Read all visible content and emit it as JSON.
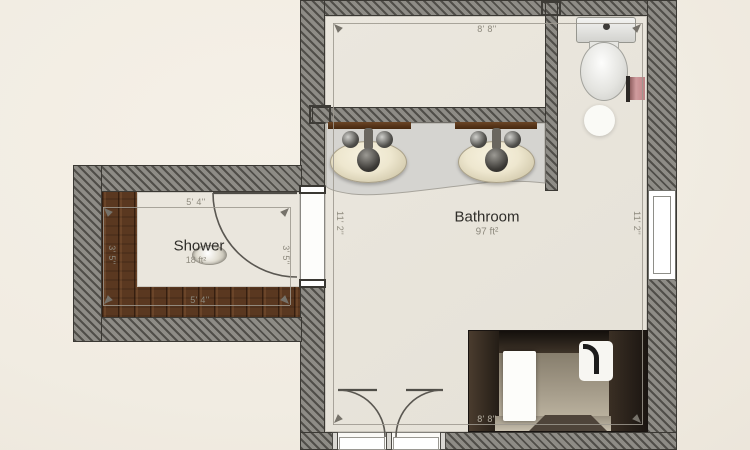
{
  "rooms": {
    "bathroom": {
      "name": "Bathroom",
      "area": "97 ft²",
      "dim_top": "8' 8''",
      "dim_bottom": "8' 8''",
      "dim_left": "11' 2''",
      "dim_right": "11' 2''"
    },
    "shower": {
      "name": "Shower",
      "area": "18 ft²",
      "dim_top": "5' 4''",
      "dim_bottom": "5' 4''",
      "dim_left": "3' 5''",
      "dim_right": "3' 5''"
    }
  },
  "icons": {
    "toilet": "toilet-top-view",
    "toilet_paper": "toilet-paper-roll",
    "sink_left": "vanity-sink-top-view",
    "sink_right": "vanity-sink-top-view",
    "vanity": "vanity-counter",
    "bathtub": "bathtub-perspective-view",
    "drain": "shower-drain",
    "ceiling_light": "ceiling-light",
    "double_door": "double-door-swing",
    "shower_door": "single-door-swing",
    "window": "window"
  },
  "colors": {
    "background": "#f1ece2",
    "wall_dark": "#504e49",
    "wall_light": "#8e8c86",
    "floor": "#e9e5dc",
    "wood": "#5a3820",
    "counter": "#d5d4d0",
    "tub_dark": "#2c241d",
    "accent_pink": "#cf9b9d",
    "dimension_text": "#8d897d"
  }
}
